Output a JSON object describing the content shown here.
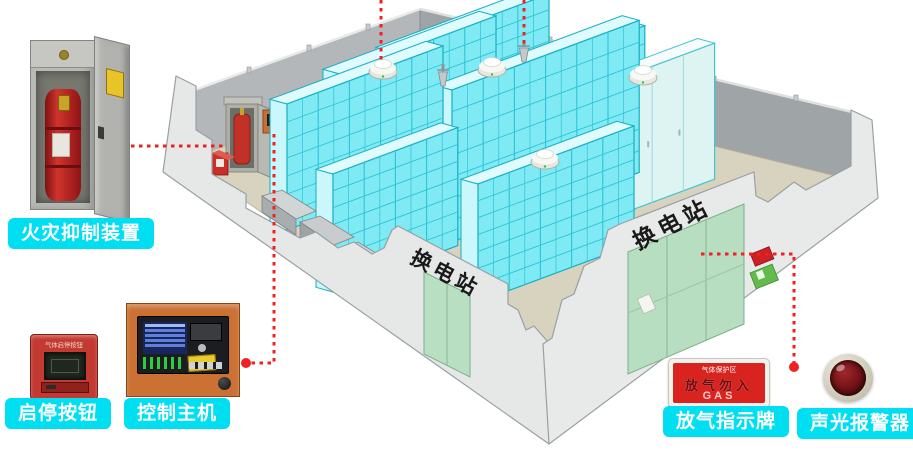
{
  "callouts": {
    "fire_suppression": {
      "label": "火灾抑制装置"
    },
    "start_stop_button": {
      "label": "启停按钮",
      "device_title": "气体启停按钮"
    },
    "control_host": {
      "label": "控制主机"
    },
    "gas_sign": {
      "label": "放气指示牌",
      "sign_top": "气体保护区",
      "sign_middle": "放气勿入",
      "sign_bottom": "GAS"
    },
    "alarm": {
      "label": "声光报警器"
    }
  },
  "room": {
    "left_door_sign": "换电站",
    "right_door_sign": "换电站"
  },
  "colors": {
    "label_bg": "#00dff2",
    "callout_line": "#ee2222",
    "rack_cyan": "#7feaf4",
    "floor": "#d7d3bf",
    "wall_left": "#b3b7b9",
    "wall_right": "#9fa4a7"
  },
  "diagram": {
    "racks": [
      {
        "x": 393,
        "y": 162,
        "units": 5,
        "h": 110,
        "type": "grid"
      },
      {
        "x": 340,
        "y": 196,
        "units": 5,
        "h": 122,
        "type": "grid"
      },
      {
        "x": 520,
        "y": 198,
        "units": 4,
        "h": 126,
        "type": "grid"
      },
      {
        "x": 563,
        "y": 228,
        "units": 2,
        "h": 138,
        "type": "plain"
      },
      {
        "x": 621,
        "y": 214,
        "units": 3,
        "h": 136,
        "type": "plain"
      },
      {
        "x": 452,
        "y": 242,
        "units": 6,
        "h": 152,
        "type": "grid"
      },
      {
        "x": 287,
        "y": 230,
        "units": 5,
        "h": 126,
        "type": "grid"
      },
      {
        "x": 333,
        "y": 292,
        "units": 4,
        "h": 118,
        "type": "grid"
      },
      {
        "x": 478,
        "y": 302,
        "units": 5,
        "h": 118,
        "type": "grid"
      }
    ],
    "detectors": [
      {
        "x": 383,
        "y": 72
      },
      {
        "x": 492,
        "y": 70
      },
      {
        "x": 545,
        "y": 162
      },
      {
        "x": 643,
        "y": 78
      }
    ],
    "nozzles": [
      {
        "x": 443,
        "y": 86
      },
      {
        "x": 524,
        "y": 62
      }
    ],
    "callout_lines": [
      {
        "pts": [
          [
            115,
            146
          ],
          [
            226,
            146
          ]
        ],
        "dot": [
          115,
          146
        ]
      },
      {
        "pts": [
          [
            274,
            134
          ],
          [
            274,
            363
          ],
          [
            246,
            363
          ]
        ],
        "dot": [
          246,
          363
        ]
      },
      {
        "pts": [
          [
            701,
            254
          ],
          [
            794,
            254
          ],
          [
            794,
            366
          ]
        ],
        "dot": [
          794,
          367
        ]
      },
      {
        "pts": [
          [
            381,
            0
          ],
          [
            381,
            64
          ]
        ],
        "dot": null
      },
      {
        "pts": [
          [
            524,
            0
          ],
          [
            524,
            48
          ]
        ],
        "dot": null
      }
    ]
  }
}
